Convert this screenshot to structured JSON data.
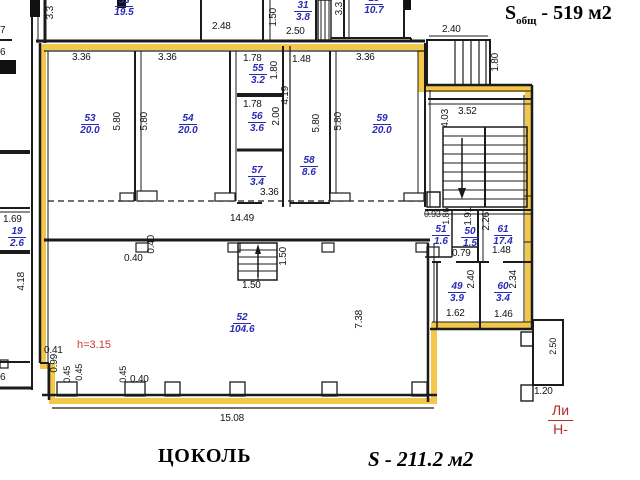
{
  "titles": {
    "total_area_s": "S",
    "total_area_sub": "общ",
    "total_area_rest": " - 519 м2",
    "floor": "ЦОКОЛЬ",
    "unit_area": "S - 211.2 м2",
    "height_note": "h=3.15",
    "stamp_top": "Ли",
    "stamp_bottom": "Н-"
  },
  "rooms": [
    {
      "id": "33",
      "number": "33",
      "area": "19.5"
    },
    {
      "id": "31",
      "number": "31",
      "area": "3.8"
    },
    {
      "id": "15",
      "number": "15",
      "area": "10.7"
    },
    {
      "id": "53",
      "number": "53",
      "area": "20.0"
    },
    {
      "id": "54",
      "number": "54",
      "area": "20.0"
    },
    {
      "id": "55",
      "number": "55",
      "area": "3.2"
    },
    {
      "id": "56",
      "number": "56",
      "area": "3.6"
    },
    {
      "id": "57",
      "number": "57",
      "area": "3.4"
    },
    {
      "id": "58",
      "number": "58",
      "area": "8.6"
    },
    {
      "id": "59",
      "number": "59",
      "area": "20.0"
    },
    {
      "id": "19",
      "number": "19",
      "area": "2.6"
    },
    {
      "id": "52",
      "number": "52",
      "area": "104.6"
    },
    {
      "id": "51",
      "number": "51",
      "area": "1.6"
    },
    {
      "id": "50",
      "number": "50",
      "area": "1.5"
    },
    {
      "id": "61",
      "number": "61",
      "area": "17.4"
    },
    {
      "id": "49",
      "number": "49",
      "area": "3.9"
    },
    {
      "id": "60",
      "number": "60",
      "area": "3.4"
    }
  ],
  "dims": [
    "3.3",
    "2.48",
    "1.50",
    "2.50",
    "3.3",
    "2.40",
    "1.80",
    "3.36",
    "3.36",
    "1.78",
    "1.48",
    "1.80",
    "4.19",
    "1.78",
    "2.00",
    "3.36",
    "5.80",
    "5.80",
    "5.80",
    "5.80",
    "3.36",
    "14.49",
    "0.40",
    "0.40",
    "1.50",
    "1.50",
    "3.52",
    "4.03",
    "0.93",
    "1.86",
    "1.91",
    "2.26",
    "0.79",
    "1.48",
    "2.40",
    "1.62",
    "2.34",
    "1.46",
    "7.38",
    "1.69",
    "4.18",
    "0.41",
    "0.99",
    "0.45",
    "0.45",
    "0.45",
    "0.40",
    "15.08",
    "1.20",
    "2.50",
    "7",
    "6",
    "6"
  ]
}
